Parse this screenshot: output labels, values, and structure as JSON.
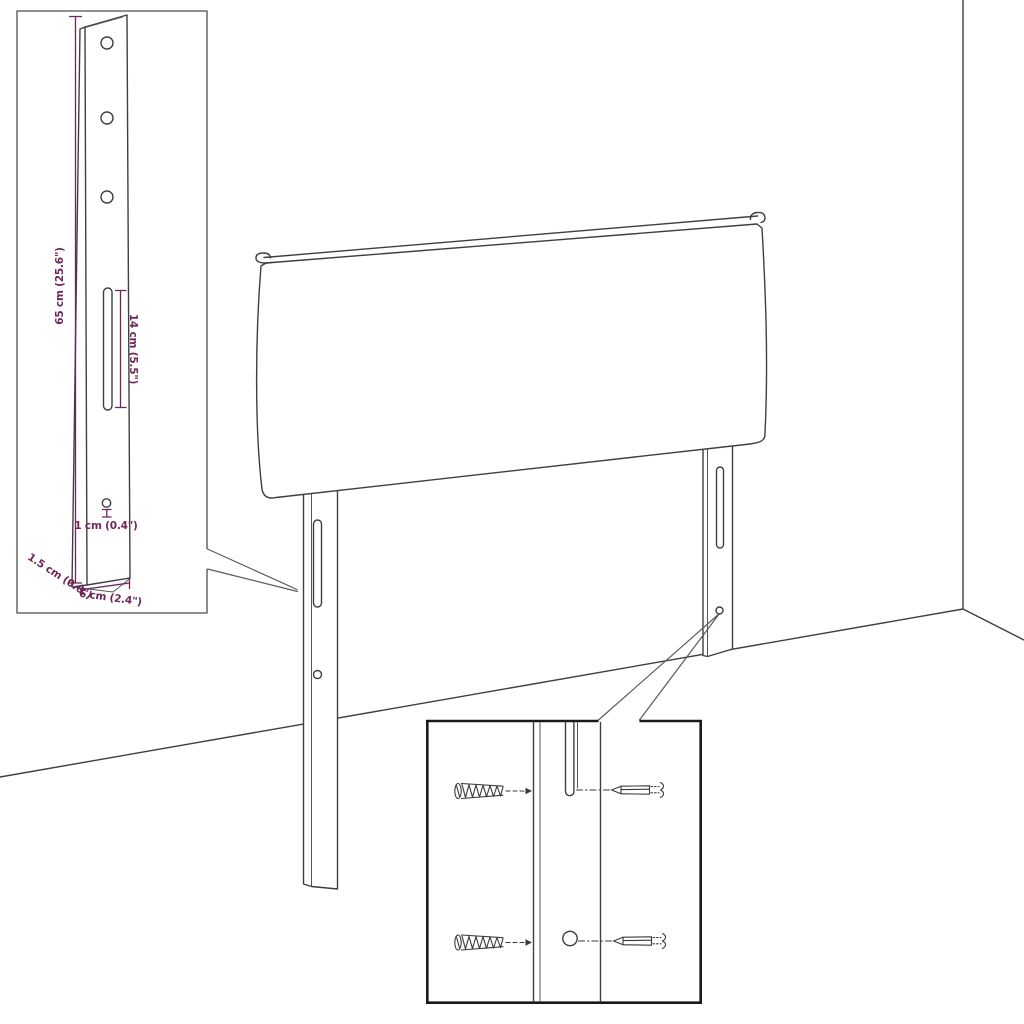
{
  "figure": {
    "type": "product-dimension-diagram",
    "subject": "upholstered headboard with two slotted mounting legs, shown in a room corner with magnified detail insets",
    "palette": {
      "background": "#ffffff",
      "drawing_line": "#3f3f3f",
      "dimension_accent": "#6e265a",
      "inset_border_light": "#4d4d4d",
      "inset_border_dark": "#1a1a1a"
    },
    "labels": {
      "leg_height": "65 cm (25.6\")",
      "slot_length": "14 cm (5.5\")",
      "hole_diameter": "1 cm (0.4\")",
      "leg_depth": "1.5 cm (0.6\")",
      "leg_width": "6 cm (2.4\")"
    }
  }
}
